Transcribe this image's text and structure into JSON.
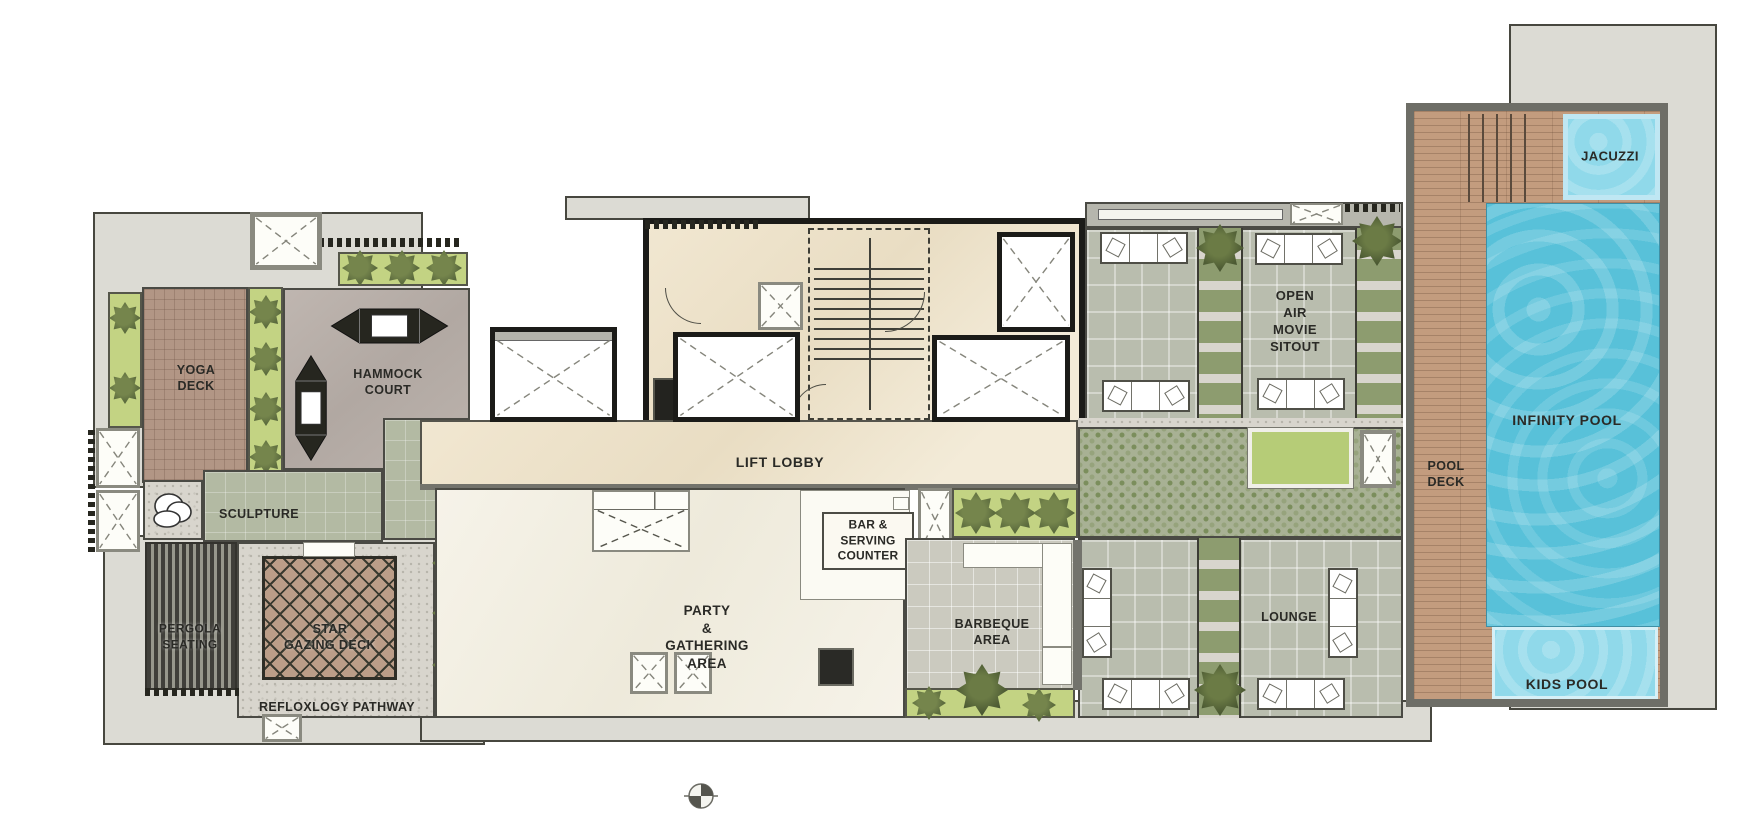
{
  "areas": {
    "yoga_deck": "YOGA\nDECK",
    "hammock_court": "HAMMOCK\nCOURT",
    "sculpture": "SCULPTURE",
    "pergola_seating": "PERGOLA\nSEATING",
    "star_gazing_deck": "STAR\nGAZING DECK",
    "refloxlogy_pathway": "REFLOXLOGY PATHWAY",
    "lift_lobby": "LIFT LOBBY",
    "party_gathering_area": "PARTY\n&\nGATHERING\nAREA",
    "bar_serving_counter": "BAR &\nSERVING\nCOUNTER",
    "barbeque_area": "BARBEQUE\nAREA",
    "open_air_movie_sitout": "OPEN\nAIR\nMOVIE\nSITOUT",
    "lounge": "LOUNGE",
    "pool_deck": "POOL\nDECK",
    "infinity_pool": "INFINITY POOL",
    "jacuzzi": "JACUZZI",
    "kids_pool": "KIDS POOL"
  },
  "icons": {
    "compass": "north-indicator-quadrant-circle",
    "lift_shaft": "crossed-box",
    "hammock": "hammock-top-view",
    "sofa": "sofa-top-view",
    "plant": "shrub-top-view",
    "tree": "tree-top-view",
    "sculpture": "boulder-cluster"
  },
  "colors": {
    "pool_water": "#58c1d9",
    "pool_light": "#90d9ea",
    "wood_deck": "#c39c7e",
    "lawn": "#b6cc77",
    "planter_green": "#c3d383",
    "foliage": "#5c6c3f",
    "paving_grey": "#b9bdae",
    "tile_green": "#b3baa3",
    "marble_cream": "#eee3cb",
    "marble_white": "#f4f1e6",
    "deck_brown": "#b29685",
    "stone_grey": "#b7aea8",
    "slab_grey": "#dcdbd4",
    "wall_dark": "#1b1b18",
    "wall_mid": "#73736c",
    "ink": "#2a2a26"
  }
}
